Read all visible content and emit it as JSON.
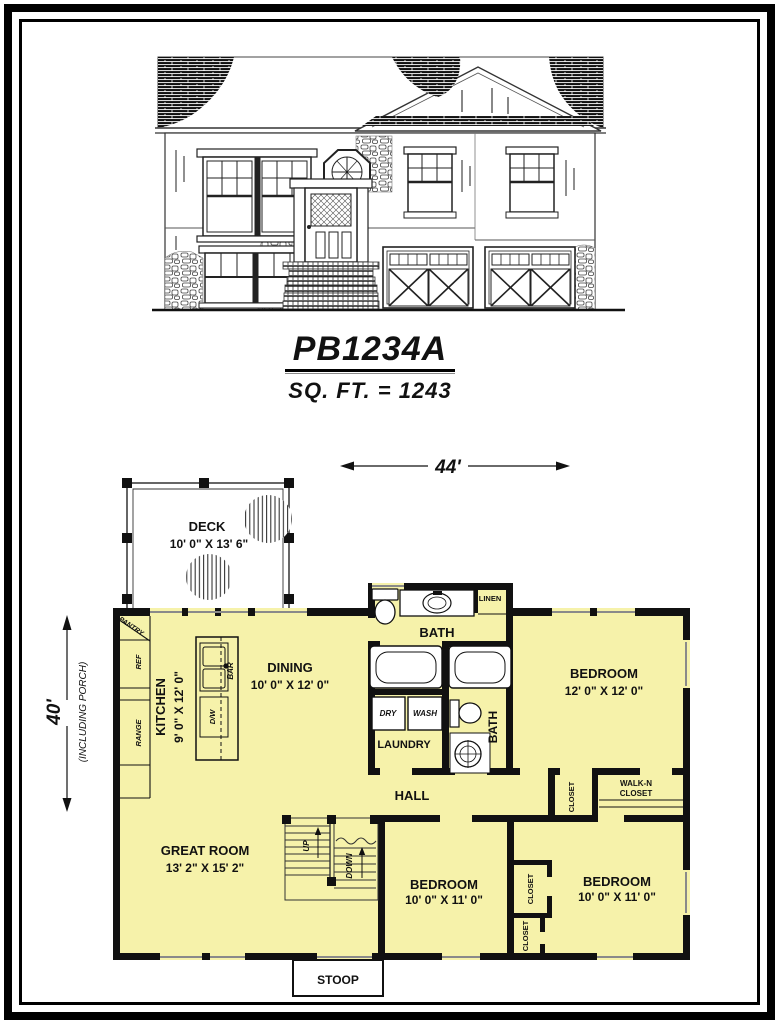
{
  "colors": {
    "room_fill": "#F6F2AA",
    "wall": "#111111",
    "deck_fill": "#FFFFFF"
  },
  "title": {
    "plan_number": "PB1234A",
    "sqft": "SQ. FT. = 1243"
  },
  "dimensions": {
    "width_label": "44'",
    "height_label": "40'",
    "height_note": "(INCLUDING PORCH)"
  },
  "floor_plan": {
    "deck": {
      "name": "DECK",
      "size": "10' 0\" X 13' 6\""
    },
    "kitchen": {
      "name": "KITCHEN",
      "size": "9' 0\" X 12' 0\""
    },
    "dining": {
      "name": "DINING",
      "size": "10' 0\" X 12' 0\""
    },
    "bath_main": {
      "name": "BATH"
    },
    "bath_second": {
      "name": "BATH"
    },
    "linen": {
      "name": "LINEN"
    },
    "laundry": {
      "name": "LAUNDRY",
      "dryer": "DRY",
      "washer": "WASH"
    },
    "bedroom_master": {
      "name": "BEDROOM",
      "size": "12' 0\" X 12' 0\""
    },
    "bedroom_two": {
      "name": "BEDROOM",
      "size": "10' 0\" X 11' 0\""
    },
    "bedroom_three": {
      "name": "BEDROOM",
      "size": "10' 0\" X 11' 0\""
    },
    "closet_hall": {
      "name": "CLOSET"
    },
    "walk_in_closet": {
      "line1": "WALK-N",
      "line2": "CLOSET"
    },
    "closet_b2": {
      "name": "CLOSET"
    },
    "closet_b3": {
      "name": "CLOSET"
    },
    "hall": {
      "name": "HALL"
    },
    "great_room": {
      "name": "GREAT ROOM",
      "size": "13' 2\" X 15' 2\""
    },
    "stoop": {
      "name": "STOOP"
    },
    "pantry": "PANTRY",
    "ref": "REF",
    "range": "RANGE",
    "dw": "D/W",
    "bar": "BAR",
    "stairs": {
      "up": "UP",
      "down": "DOWN"
    }
  }
}
